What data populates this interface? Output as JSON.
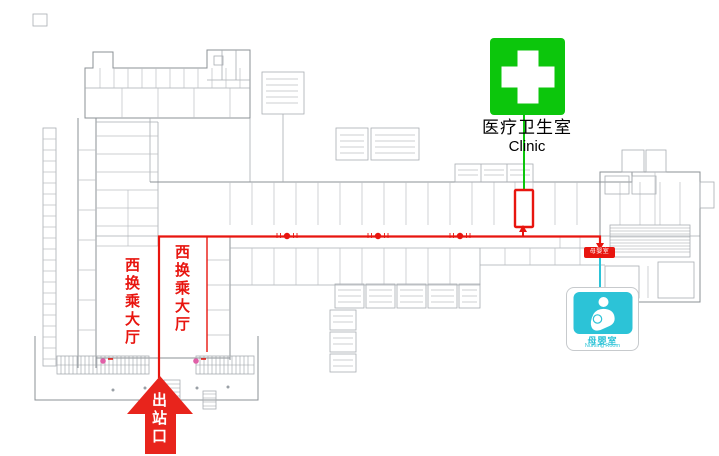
{
  "signs": {
    "clinic": {
      "label_zh": "医疗卫生室",
      "label_en": "Clinic"
    },
    "nursing": {
      "label_zh": "母婴室",
      "label_en": "Nursing Room",
      "marker_label": "母婴室"
    }
  },
  "halls": {
    "west_hall_label": "西换乘大厅"
  },
  "exit": {
    "label": "出站口"
  },
  "icons": {
    "clinic": "first-aid-cross-icon",
    "nursing": "mother-nursing-baby-icon",
    "exit": "up-arrow-icon"
  },
  "colors": {
    "route_red": "#E8150F",
    "clinic_green": "#0CC60C",
    "nursing_teal": "#2CC3D7",
    "marker_pink": "#E060A8"
  }
}
